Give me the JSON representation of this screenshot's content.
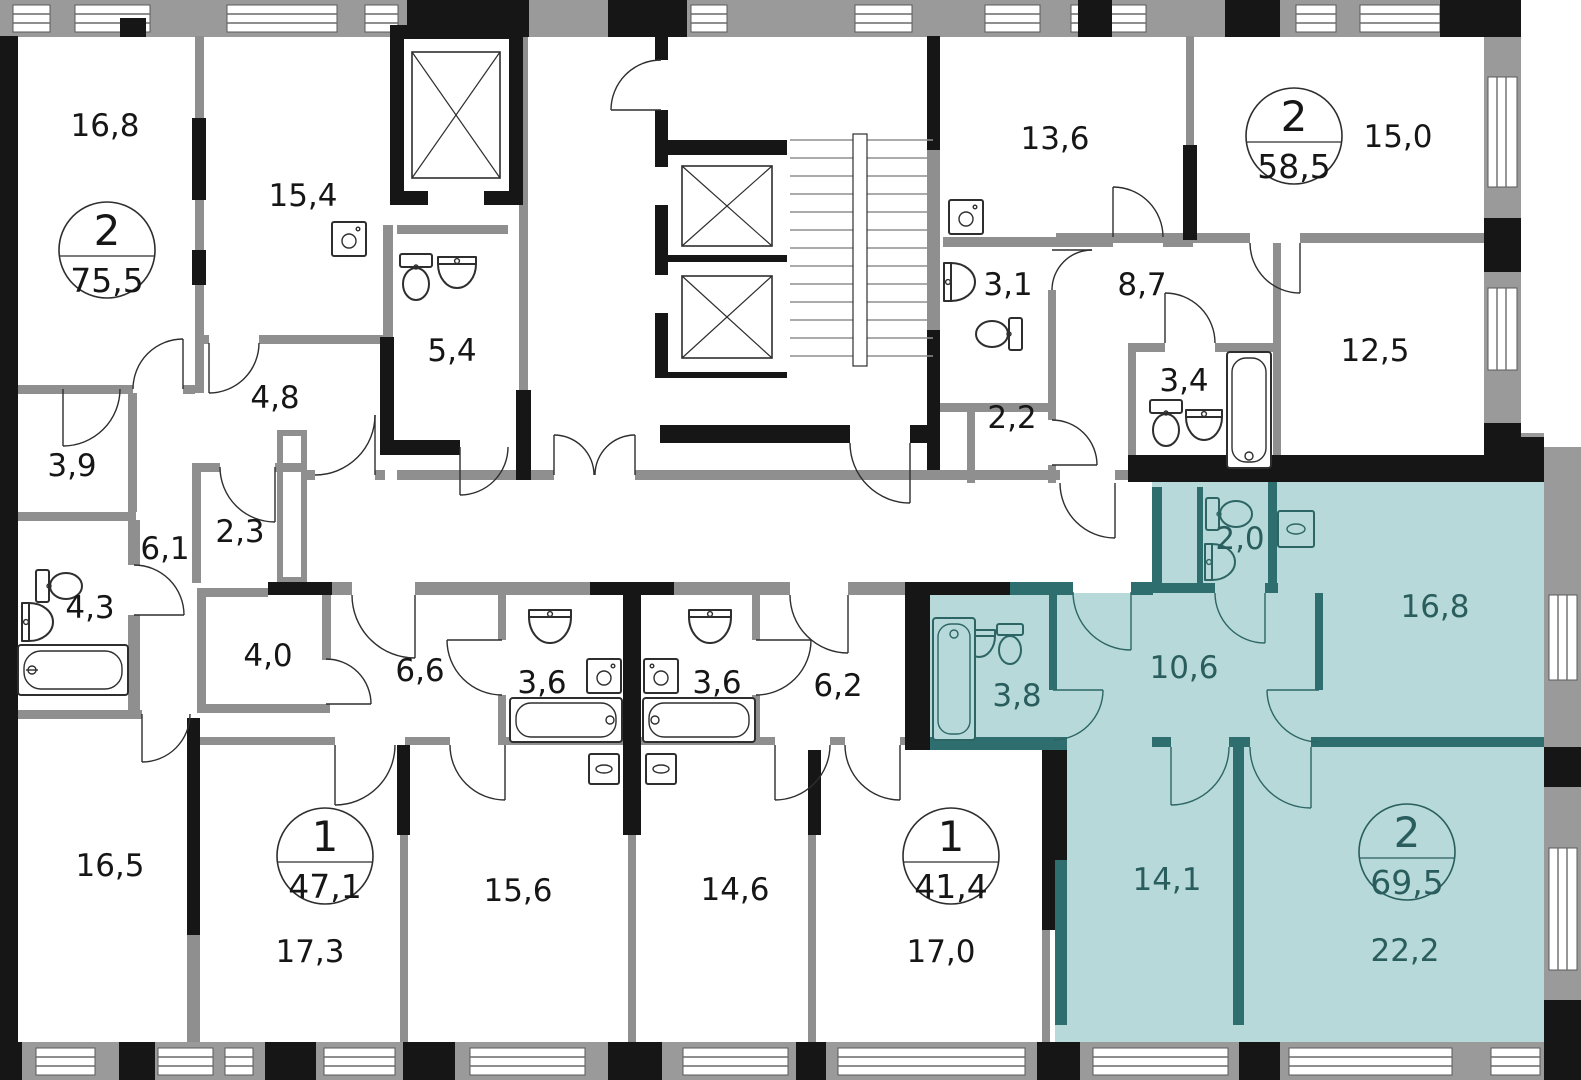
{
  "meta": {
    "type": "floor-plan",
    "highlighted_apartment": {
      "rooms": "2",
      "area": "69,5"
    }
  },
  "colors": {
    "wall_interior": "#8f8f8f",
    "wall_structural": "#161616",
    "highlight_fill": "#b7d9d9",
    "highlight_wall": "#2e6e6e",
    "highlight_text": "#2a5d5d",
    "label_text": "#161616"
  },
  "rooms": [
    {
      "name": "apt-a-room-16-8",
      "label": "16,8"
    },
    {
      "name": "apt-a-room-15-4",
      "label": "15,4"
    },
    {
      "name": "apt-a-bath-5-4",
      "label": "5,4"
    },
    {
      "name": "apt-a-hall-4-8",
      "label": "4,8"
    },
    {
      "name": "apt-a-room-3-9",
      "label": "3,9"
    },
    {
      "name": "apt-a-hall-6-1",
      "label": "6,1"
    },
    {
      "name": "apt-a-store-2-3",
      "label": "2,3"
    },
    {
      "name": "apt-a-bath-4-3",
      "label": "4,3"
    },
    {
      "name": "apt-a-room-16-5",
      "label": "16,5"
    },
    {
      "name": "apt-c-room-17-3",
      "label": "17,3"
    },
    {
      "name": "apt-c-hall-4-0",
      "label": "4,0"
    },
    {
      "name": "apt-c-kitchen-6-6",
      "label": "6,6"
    },
    {
      "name": "apt-c-bath-3-6",
      "label": "3,6"
    },
    {
      "name": "apt-c-room-15-6",
      "label": "15,6"
    },
    {
      "name": "apt-d-bath-3-6",
      "label": "3,6"
    },
    {
      "name": "apt-d-hall-6-2",
      "label": "6,2"
    },
    {
      "name": "apt-d-room-14-6",
      "label": "14,6"
    },
    {
      "name": "apt-d-room-17-0",
      "label": "17,0"
    },
    {
      "name": "apt-b-room-13-6",
      "label": "13,6"
    },
    {
      "name": "apt-b-room-15-0",
      "label": "15,0"
    },
    {
      "name": "apt-b-bath-3-1",
      "label": "3,1"
    },
    {
      "name": "apt-b-hall-8-7",
      "label": "8,7"
    },
    {
      "name": "apt-b-store-2-2",
      "label": "2,2"
    },
    {
      "name": "apt-b-bath-3-4",
      "label": "3,4"
    },
    {
      "name": "apt-b-room-12-5",
      "label": "12,5"
    },
    {
      "name": "apt-e-wc-2-0",
      "label": "2,0"
    },
    {
      "name": "apt-e-room-16-8",
      "label": "16,8"
    },
    {
      "name": "apt-e-hall-10-6",
      "label": "10,6"
    },
    {
      "name": "apt-e-bath-3-8",
      "label": "3,8"
    },
    {
      "name": "apt-e-room-14-1",
      "label": "14,1"
    },
    {
      "name": "apt-e-room-22-2",
      "label": "22,2"
    }
  ],
  "apartments": [
    {
      "name": "apartment-2-rooms-75-5",
      "rooms": "2",
      "area": "75,5",
      "highlighted": false
    },
    {
      "name": "apartment-2-rooms-58-5",
      "rooms": "2",
      "area": "58,5",
      "highlighted": false
    },
    {
      "name": "apartment-1-room-47-1",
      "rooms": "1",
      "area": "47,1",
      "highlighted": false
    },
    {
      "name": "apartment-1-room-41-4",
      "rooms": "1",
      "area": "41,4",
      "highlighted": false
    },
    {
      "name": "apartment-2-rooms-69-5",
      "rooms": "2",
      "area": "69,5",
      "highlighted": true
    }
  ]
}
